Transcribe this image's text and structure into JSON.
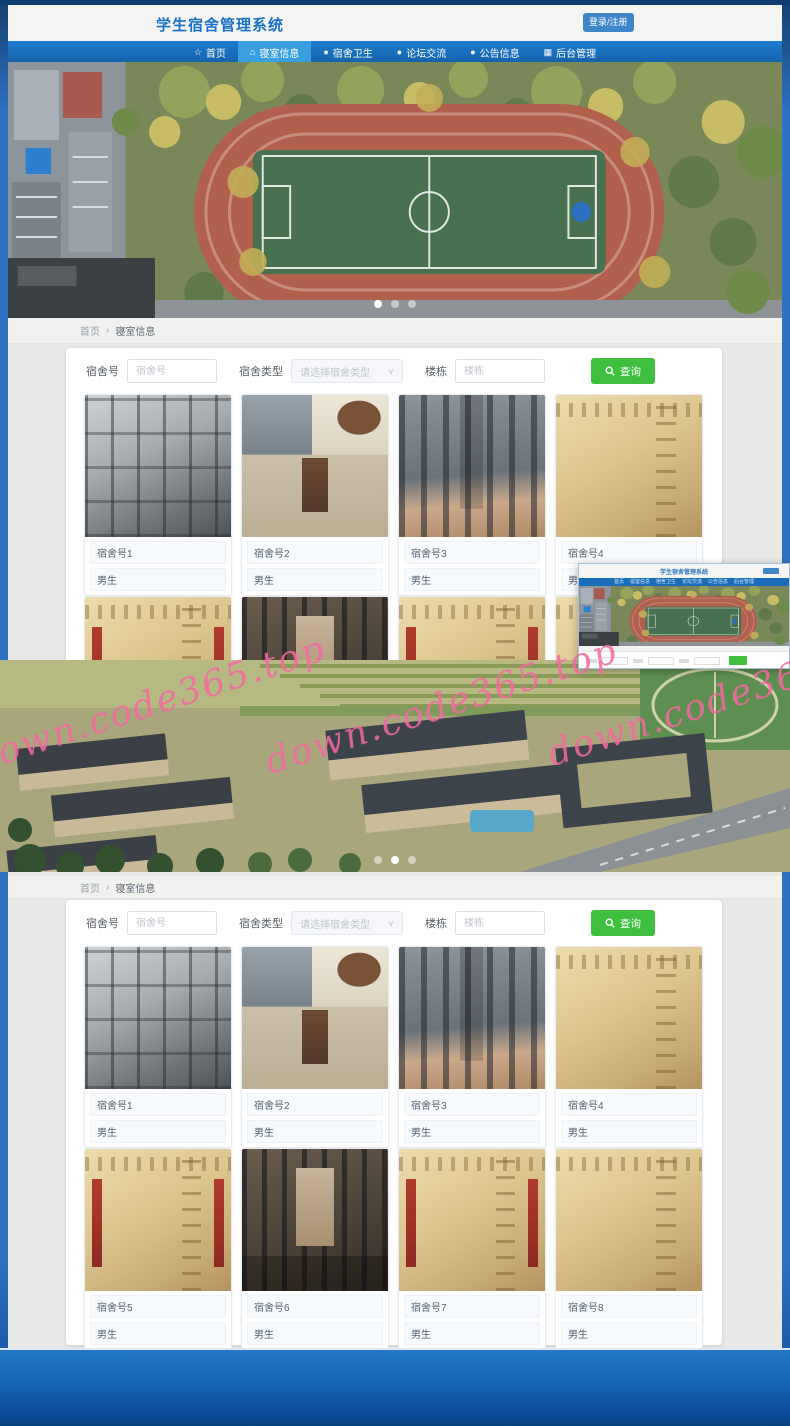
{
  "app": {
    "title": "学生宿舍管理系统",
    "login_label": "登录/注册"
  },
  "nav": {
    "items": [
      {
        "label": "首页",
        "icon": "star-icon",
        "glyph": "☆",
        "active": false
      },
      {
        "label": "寝室信息",
        "icon": "home-icon",
        "glyph": "⌂",
        "active": true
      },
      {
        "label": "宿舍卫生",
        "icon": "circle-icon",
        "glyph": "●",
        "active": false
      },
      {
        "label": "论坛交流",
        "icon": "circle-icon",
        "glyph": "●",
        "active": false
      },
      {
        "label": "公告信息",
        "icon": "circle-icon",
        "glyph": "●",
        "active": false
      },
      {
        "label": "后台管理",
        "icon": "grid-icon",
        "glyph": "▦",
        "active": false
      }
    ]
  },
  "breadcrumb": {
    "home": "首页",
    "separator": "›",
    "current": "寝室信息"
  },
  "search": {
    "dorm_no_label": "宿舍号",
    "dorm_no_placeholder": "宿舍号",
    "type_label": "宿舍类型",
    "type_placeholder": "请选择宿舍类型",
    "building_label": "楼栋",
    "building_placeholder": "楼栋",
    "query_label": "查询"
  },
  "icons": {
    "chevron_down": "∨"
  },
  "cards": [
    {
      "no": "宿舍号1",
      "gender": "男生"
    },
    {
      "no": "宿舍号2",
      "gender": "男生"
    },
    {
      "no": "宿舍号3",
      "gender": "男生"
    },
    {
      "no": "宿舍号4",
      "gender": "男生"
    },
    {
      "no": "宿舍号5",
      "gender": "男生"
    },
    {
      "no": "宿舍号6",
      "gender": "男生"
    },
    {
      "no": "宿舍号7",
      "gender": "男生"
    },
    {
      "no": "宿舍号8",
      "gender": "男生"
    }
  ],
  "carousel": {
    "dot_count": 3,
    "hero1_active_index": 0,
    "hero2_active_index": 1
  },
  "watermark": {
    "text": "down.code365.top",
    "color": "#f469a0"
  },
  "colors": {
    "nav_blue": "#1a6db8",
    "nav_active": "#38a0de",
    "accent_green": "#3fbf3f",
    "title_blue": "#1a71c8",
    "footer_blue": "#1565b6"
  }
}
